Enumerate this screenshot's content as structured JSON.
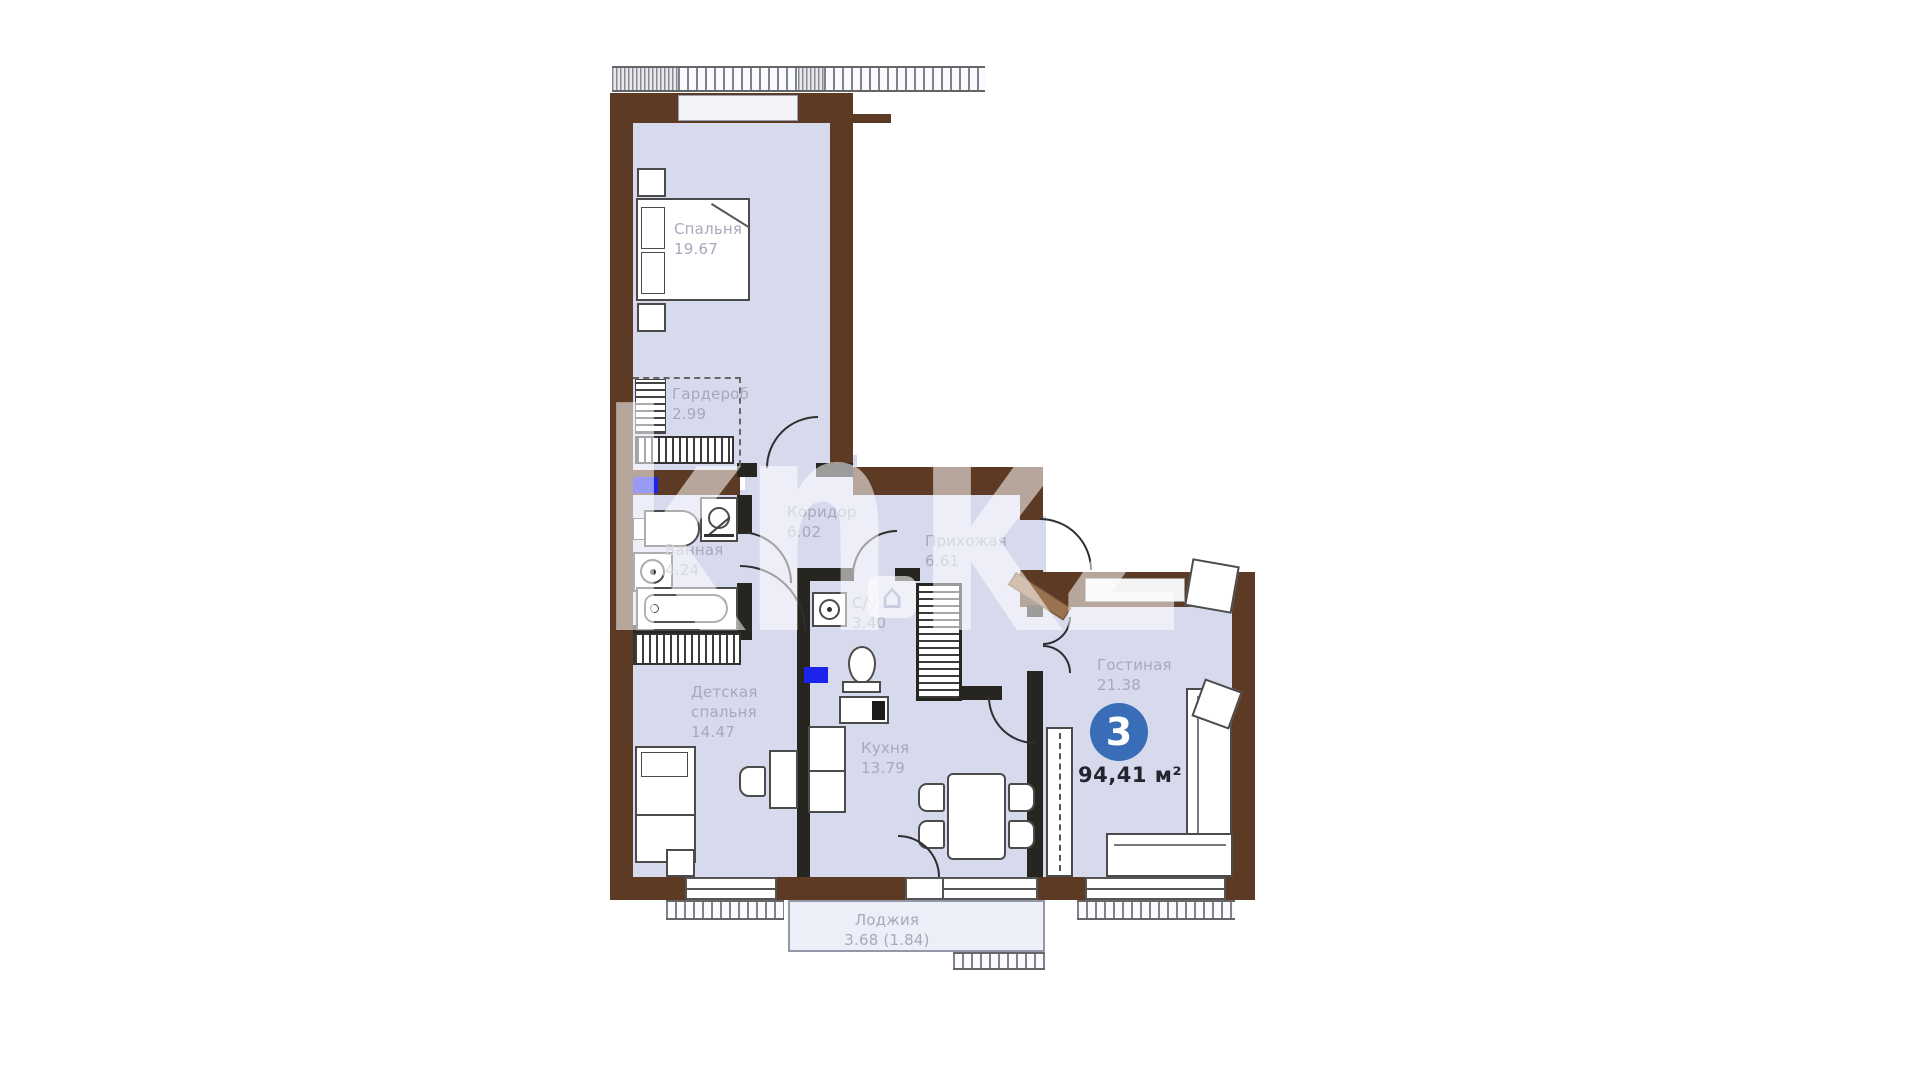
{
  "plan": {
    "watermark": {
      "part1": "kn",
      "part2": "kz",
      "house_icon": "⌂"
    },
    "badge": {
      "rooms": "3",
      "total_area": "94,41 м²"
    },
    "rooms": [
      {
        "name": "Спальня",
        "area": "19.67"
      },
      {
        "name": "Гардероб",
        "area": "2.99"
      },
      {
        "name": "Коридор",
        "area": "6.02"
      },
      {
        "name": "Прихожая",
        "area": "6.61"
      },
      {
        "name": "Ванная",
        "area": "4.24"
      },
      {
        "name": "С/у",
        "area": "3.40"
      },
      {
        "name": "Детская спальня",
        "area": "14.47"
      },
      {
        "name": "Кухня",
        "area": "13.79"
      },
      {
        "name": "Гостиная",
        "area": "21.38"
      },
      {
        "name": "Лоджия",
        "area": "3.68 (1.84)"
      }
    ],
    "colors": {
      "wall": "#5d3a23",
      "partition": "#26251f",
      "floor": "#d7daed",
      "marker": "#1c23ea",
      "badge": "#3a6db8",
      "label": "#a5a9bb"
    }
  }
}
